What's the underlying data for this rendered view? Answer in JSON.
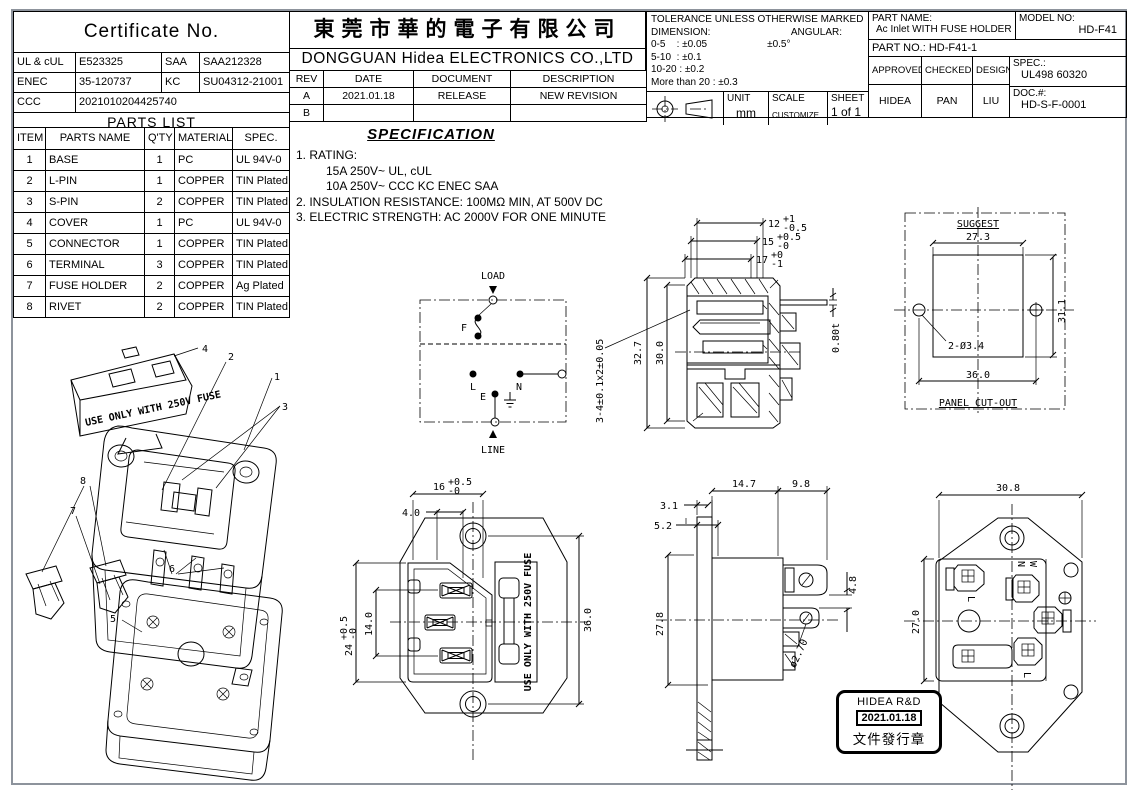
{
  "certificate": {
    "title": "Certificate No.",
    "rows": [
      [
        "UL & cUL",
        "E523325",
        "SAA",
        "SAA212328"
      ],
      [
        "ENEC",
        "35-120737",
        "KC",
        "SU04312-21001"
      ],
      [
        "CCC",
        "2021010204425740",
        "",
        ""
      ]
    ],
    "footer": "PARTS LIST"
  },
  "parts_list": {
    "headers": [
      "ITEM",
      "PARTS NAME",
      "Q'TY",
      "MATERIALS",
      "SPEC."
    ],
    "rows": [
      [
        "1",
        "BASE",
        "1",
        "PC",
        "UL 94V-0"
      ],
      [
        "2",
        "L-PIN",
        "1",
        "COPPER",
        "TIN Plated"
      ],
      [
        "3",
        "S-PIN",
        "2",
        "COPPER",
        "TIN Plated"
      ],
      [
        "4",
        "COVER",
        "1",
        "PC",
        "UL 94V-0"
      ],
      [
        "5",
        "CONNECTOR",
        "1",
        "COPPER",
        "TIN Plated"
      ],
      [
        "6",
        "TERMINAL",
        "3",
        "COPPER",
        "TIN Plated"
      ],
      [
        "7",
        "FUSE HOLDER",
        "2",
        "COPPER",
        "Ag Plated"
      ],
      [
        "8",
        "RIVET",
        "2",
        "COPPER",
        "TIN Plated"
      ]
    ]
  },
  "company": {
    "name_cn": "東莞市華的電子有限公司",
    "name_en": "DONGGUAN Hidea ELECTRONICS CO.,LTD"
  },
  "revision": {
    "headers": [
      "REV",
      "DATE",
      "DOCUMENT",
      "DESCRIPTION"
    ],
    "rows": [
      [
        "A",
        "2021.01.18",
        "RELEASE",
        "NEW REVISION"
      ],
      [
        "B",
        "",
        "",
        ""
      ]
    ]
  },
  "tolerance": {
    "title": "TOLERANCE UNLESS OTHERWISE MARKED",
    "dimension_label": "DIMENSION:",
    "angular_label": "ANGULAR:",
    "angular_value": "±0.5°",
    "ranges": [
      "0-5    : ±0.05",
      "5-10  : ±0.1",
      "10-20 : ±0.2",
      "More than 20 : ±0.3"
    ],
    "unit_label": "UNIT",
    "unit_value": "mm",
    "scale_label": "SCALE",
    "scale_value": "CUSTOMIZE",
    "sheet_label": "SHEET",
    "sheet_value": "1 of 1"
  },
  "title_block": {
    "part_name_label": "PART NAME:",
    "part_name": "Ac Inlet WITH FUSE HOLDER",
    "model_no_label": "MODEL NO:",
    "model_no": "HD-F41",
    "part_no": "PART NO.: HD-F41-1",
    "approved_label": "APPROVED",
    "checked_label": "CHECKED",
    "designer_label": "DESIGNER",
    "approved": "HIDEA",
    "checked": "PAN",
    "designer": "LIU",
    "spec_label": "SPEC.:",
    "spec_value": "UL498 60320",
    "doc_label": "DOC.#:",
    "doc_value": "HD-S-F-0001"
  },
  "specification": {
    "title": "SPECIFICATION",
    "line1": "1. RATING:",
    "line2": "15A 250V~ UL, cUL",
    "line3": "10A 250V~ CCC KC ENEC SAA",
    "line4": "2. INSULATION RESISTANCE: 100MΩ MIN, AT 500V DC",
    "line5": "3. ELECTRIC STRENGTH: AC 2000V FOR ONE MINUTE"
  },
  "wiring": {
    "load": "LOAD",
    "line": "LINE",
    "fuse": "F",
    "l": "L",
    "n": "N",
    "e": "E"
  },
  "section_view": {
    "height_outer": "32.7",
    "height_inner": "30.0",
    "depth1": "12",
    "depth1_up": "+1",
    "depth1_dn": "-0.5",
    "depth2": "15",
    "depth2_up": "+0.5",
    "depth2_dn": "-0",
    "depth3": "17",
    "depth3_up": "+0",
    "depth3_dn": "-1",
    "pin_thickness": "0.80t",
    "pin_spec": "3-4±0.1x2±0.05"
  },
  "panel_cutout": {
    "suggest": "SUGGEST",
    "width": "27.3",
    "height": "31.1",
    "holes": "2-Ø3.4",
    "hole_spacing": "36.0",
    "label": "PANEL CUT-OUT"
  },
  "front_view": {
    "width": "16",
    "width_up": "+0.5",
    "width_dn": "-0",
    "offset": "4.0",
    "height": "24",
    "height_up": "+0.5",
    "height_dn": "-0",
    "pin_span": "14.0",
    "mount_span": "36.0",
    "fuse_text": "USE ONLY WITH 250V FUSE"
  },
  "side_view": {
    "flange1": "3.1",
    "flange2": "5.2",
    "body_depth": "14.7",
    "terminal_depth": "9.8",
    "flange_height": "27.8",
    "terminal_gap": "4.8",
    "hole_dia": "ø2.70"
  },
  "rear_view": {
    "width": "30.8",
    "height": "27.0",
    "n": "N",
    "w": "W",
    "l_bottom": "L",
    "l_left": "L"
  },
  "exploded_view": {
    "callout1": "1",
    "callout2": "2",
    "callout3": "3",
    "callout4": "4",
    "callout5": "5",
    "callout6": "6",
    "callout7": "7",
    "callout8": "8",
    "cover_text": "USE ONLY WITH 250V FUSE"
  },
  "stamp": {
    "line1": "HIDEA R&D",
    "line2": "2021.01.18",
    "line3": "文件發行章"
  }
}
